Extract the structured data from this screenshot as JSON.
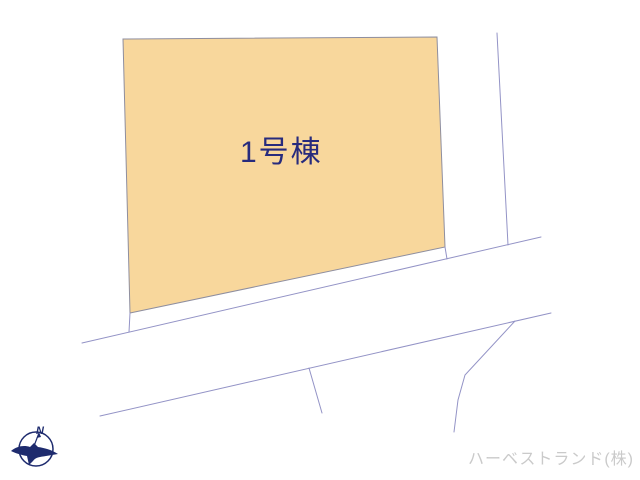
{
  "colors": {
    "background": "#ffffff",
    "plot-fill": "#f8d79c",
    "plot-stroke": "#8e8e9f",
    "road-line": "#9393c6",
    "plot-label": "#272b7d",
    "compass": "#1e2b6e",
    "credit": "#cacaca"
  },
  "plot": {
    "label": "1号棟"
  },
  "compass": {
    "north_label": "N"
  },
  "credit": {
    "text": "ハーベストランド(株)"
  }
}
